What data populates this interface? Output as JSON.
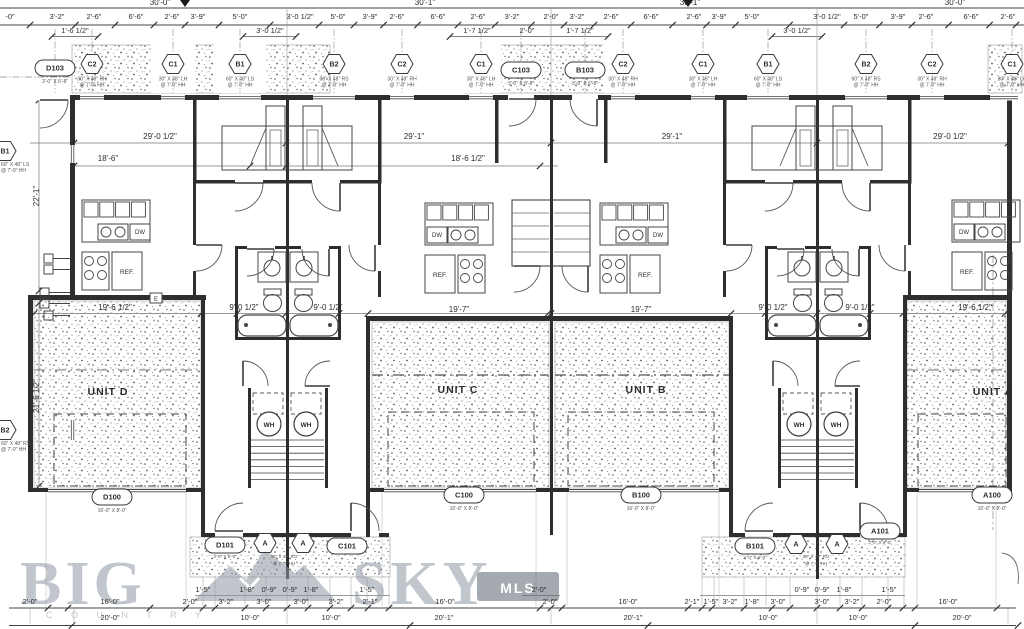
{
  "watermark": {
    "big": "BIG",
    "sky": "SKY",
    "country": "C  O  U  N  T  R  Y",
    "badge": "MLS",
    "color": "#8e98a4",
    "badge_color": "#5a6570"
  },
  "drawing": {
    "unit_labels": [
      {
        "x": 108,
        "y": 395,
        "t": "UNIT D"
      },
      {
        "x": 458,
        "y": 393,
        "t": "UNIT C"
      },
      {
        "x": 646,
        "y": 393,
        "t": "UNIT B"
      },
      {
        "x": 993,
        "y": 395,
        "t": "UNIT A"
      }
    ],
    "top_totals": [
      {
        "x": 160,
        "t": "30'-0\""
      },
      {
        "x": 425,
        "t": "30'-1\""
      },
      {
        "x": 690,
        "t": "30'-1\""
      },
      {
        "x": 955,
        "t": "30'-0\""
      }
    ],
    "top_row1": [
      {
        "x": 10,
        "t": "-0\""
      },
      {
        "x": 57,
        "t": "3'-2\""
      },
      {
        "x": 94,
        "t": "2'-6\""
      },
      {
        "x": 136,
        "t": "6'-6\""
      },
      {
        "x": 172,
        "t": "2'-6\""
      },
      {
        "x": 198,
        "t": "3'-9\""
      },
      {
        "x": 240,
        "t": "5'-0\""
      },
      {
        "x": 300,
        "t": "3'-0 1/2\""
      },
      {
        "x": 338,
        "t": "5'-0\""
      },
      {
        "x": 370,
        "t": "3'-9\""
      },
      {
        "x": 397,
        "t": "2'-6\""
      },
      {
        "x": 438,
        "t": "6'-6\""
      },
      {
        "x": 478,
        "t": "2'-6\""
      },
      {
        "x": 512,
        "t": "3'-2\""
      },
      {
        "x": 551,
        "t": "2'-0\""
      },
      {
        "x": 577,
        "t": "3'-2\""
      },
      {
        "x": 611,
        "t": "2'-6\""
      },
      {
        "x": 651,
        "t": "6'-6\""
      },
      {
        "x": 694,
        "t": "2'-6\""
      },
      {
        "x": 719,
        "t": "3'-9\""
      },
      {
        "x": 752,
        "t": "5'-0\""
      },
      {
        "x": 827,
        "t": "3'-0 1/2\""
      },
      {
        "x": 861,
        "t": "5'-0\""
      },
      {
        "x": 898,
        "t": "3'-9\""
      },
      {
        "x": 926,
        "t": "2'-6\""
      },
      {
        "x": 971,
        "t": "6'-6\""
      },
      {
        "x": 1008,
        "t": "2'-6\""
      }
    ],
    "top_row2": [
      {
        "x": 75,
        "t": "1'-6 1/2\""
      },
      {
        "x": 270,
        "t": "3'-0 1/2\""
      },
      {
        "x": 477,
        "t": "1'-7 1/2\""
      },
      {
        "x": 527,
        "t": "2'-0\""
      },
      {
        "x": 580,
        "t": "1'-7 1/2\""
      },
      {
        "x": 797,
        "t": "3'-0 1/2\""
      }
    ],
    "window_tags": [
      {
        "x": 55,
        "y": 68,
        "label": "D103",
        "shape": "oval",
        "spec": [
          "3'-0\" X 6'-8\""
        ]
      },
      {
        "x": 92,
        "y": 64,
        "label": "C2",
        "shape": "hex",
        "spec": [
          "30\" X 48\" RH",
          "@ 7'-0\" HH"
        ]
      },
      {
        "x": 173,
        "y": 64,
        "label": "C1",
        "shape": "hex",
        "spec": [
          "30\" X 48\" LH",
          "@ 7'-0\" HH"
        ]
      },
      {
        "x": 240,
        "y": 64,
        "label": "B1",
        "shape": "hex",
        "spec": [
          "60\" X 48\" LS",
          "@ 7'-0\" HH"
        ]
      },
      {
        "x": 334,
        "y": 64,
        "label": "B2",
        "shape": "hex",
        "spec": [
          "60\" X 48\" RS",
          "@ 7'-0\" HH"
        ]
      },
      {
        "x": 402,
        "y": 64,
        "label": "C2",
        "shape": "hex",
        "spec": [
          "30\" X 48\" RH",
          "@ 7'-0\" HH"
        ]
      },
      {
        "x": 481,
        "y": 64,
        "label": "C1",
        "shape": "hex",
        "spec": [
          "30\" X 48\" LH",
          "@ 7'-0\" HH"
        ]
      },
      {
        "x": 521,
        "y": 70,
        "label": "C103",
        "shape": "oval",
        "spec": [
          "3'-0\" X 6'-8\""
        ]
      },
      {
        "x": 585,
        "y": 70,
        "label": "B103",
        "shape": "oval",
        "spec": [
          "3'-0\" X 6'-8\""
        ]
      },
      {
        "x": 623,
        "y": 64,
        "label": "C2",
        "shape": "hex",
        "spec": [
          "30\" X 48\" RH",
          "@ 7'-0\" HH"
        ]
      },
      {
        "x": 703,
        "y": 64,
        "label": "C1",
        "shape": "hex",
        "spec": [
          "30\" X 48\" LH",
          "@ 7'-0\" HH"
        ]
      },
      {
        "x": 768,
        "y": 64,
        "label": "B1",
        "shape": "hex",
        "spec": [
          "60\" X 48\" LS",
          "@ 7'-0\" HH"
        ]
      },
      {
        "x": 866,
        "y": 64,
        "label": "B2",
        "shape": "hex",
        "spec": [
          "60\" X 48\" RS",
          "@ 7'-0\" HH"
        ]
      },
      {
        "x": 932,
        "y": 64,
        "label": "C2",
        "shape": "hex",
        "spec": [
          "30\" X 48\" RH",
          "@ 7'-0\" HH"
        ]
      },
      {
        "x": 1012,
        "y": 64,
        "label": "C1",
        "shape": "hex",
        "spec": [
          "30\" X 48\" LH",
          "@ 7'-0\" HH"
        ]
      }
    ],
    "left_tags": [
      {
        "y": 151,
        "label": "B1",
        "spec": [
          "60\" X 48\" LS",
          "@ 7'-0\" HH"
        ]
      },
      {
        "y": 430,
        "label": "B2",
        "spec": [
          "60\" X 48\" RS",
          "@ 7'-0\" HH"
        ]
      }
    ],
    "interior_dims": [
      {
        "x": 160,
        "y": 139,
        "t": "29'-0 1/2\""
      },
      {
        "x": 414,
        "y": 139,
        "t": "29'-1\""
      },
      {
        "x": 672,
        "y": 139,
        "t": "29'-1\""
      },
      {
        "x": 950,
        "y": 139,
        "t": "29'-0 1/2\""
      },
      {
        "x": 108,
        "y": 161,
        "t": "18'-6\""
      },
      {
        "x": 468,
        "y": 161,
        "t": "18'-6 1/2\""
      },
      {
        "x": 115,
        "y": 310,
        "t": "19'-6 1/2\""
      },
      {
        "x": 244,
        "y": 310,
        "t": "9'-0 1/2\""
      },
      {
        "x": 328,
        "y": 310,
        "t": "9'-0 1/2\""
      },
      {
        "x": 459,
        "y": 312,
        "t": "19'-7\""
      },
      {
        "x": 641,
        "y": 312,
        "t": "19'-7\""
      },
      {
        "x": 773,
        "y": 310,
        "t": "9'-0 1/2\""
      },
      {
        "x": 860,
        "y": 310,
        "t": "9'-0 1/2\""
      },
      {
        "x": 975,
        "y": 310,
        "t": "19'-6 1/2\""
      }
    ],
    "vertical_dims": [
      {
        "x": 39,
        "y": 196,
        "t": "22'-1\""
      },
      {
        "x": 39,
        "y": 396,
        "t": "21'-6 1/2\""
      }
    ],
    "garage_tags": [
      {
        "x": 112,
        "y": 497,
        "t": "D100",
        "sub": "16'-0\" X 8'-0\""
      },
      {
        "x": 464,
        "y": 495,
        "t": "C100",
        "sub": "16'-0\" X 8'-0\""
      },
      {
        "x": 641,
        "y": 495,
        "t": "B100",
        "sub": "16'-0\" X 8'-0\""
      },
      {
        "x": 992,
        "y": 495,
        "t": "A100",
        "sub": "16'-0\" X 8'-0\""
      }
    ],
    "entry_oval_tags": [
      {
        "x": 225,
        "y": 545,
        "t": "D101",
        "sub": "3'-0\" X 8'-0\""
      },
      {
        "x": 347,
        "y": 546,
        "t": "C101",
        "sub": ""
      },
      {
        "x": 755,
        "y": 546,
        "t": "B101",
        "sub": "3'-0\" X 8'-0\""
      },
      {
        "x": 880,
        "y": 531,
        "t": "A101",
        "sub": "3'-0\" X 8'-0\""
      }
    ],
    "entry_hex_tags": [
      {
        "x": 265,
        "y": 543,
        "t": "A"
      },
      {
        "x": 303,
        "y": 543,
        "t": "A"
      },
      {
        "x": 796,
        "y": 544,
        "t": "A"
      },
      {
        "x": 837,
        "y": 544,
        "t": "A"
      }
    ],
    "entry_hex_specs": [
      {
        "x": 284,
        "y": 558,
        "t": "36\" X 42\" RO"
      },
      {
        "x": 284,
        "y": 565,
        "t": "@ 7'-0\" HH"
      },
      {
        "x": 816,
        "y": 558,
        "t": "36\" X 42\" RO"
      },
      {
        "x": 816,
        "y": 565,
        "t": "@ 7'-0\" HH"
      }
    ],
    "bottom_rowA": [
      {
        "x": 203,
        "t": "1'-5\""
      },
      {
        "x": 247,
        "t": "1'-8\""
      },
      {
        "x": 269,
        "t": "0'-9\""
      },
      {
        "x": 290,
        "t": "0'-9\""
      },
      {
        "x": 311,
        "t": "1'-8\""
      },
      {
        "x": 367,
        "t": "1'-5\""
      },
      {
        "x": 539,
        "t": "2'-0\""
      },
      {
        "x": 802,
        "t": "0'-9\""
      },
      {
        "x": 822,
        "t": "0'-9\""
      },
      {
        "x": 844,
        "t": "1'-8\""
      },
      {
        "x": 889,
        "t": "1'-5\""
      }
    ],
    "bottom_rowB": [
      {
        "x": 30,
        "t": "2'-0\""
      },
      {
        "x": 110,
        "t": "16'-0\""
      },
      {
        "x": 190,
        "t": "2'-0\""
      },
      {
        "x": 226,
        "t": "3'-2\""
      },
      {
        "x": 264,
        "t": "3'-0\""
      },
      {
        "x": 301,
        "t": "3'-0\""
      },
      {
        "x": 336,
        "t": "3'-2\""
      },
      {
        "x": 370,
        "t": "2'-1\""
      },
      {
        "x": 445,
        "t": "16'-0\""
      },
      {
        "x": 550,
        "t": "2'-0\""
      },
      {
        "x": 628,
        "t": "16'-0\""
      },
      {
        "x": 692,
        "t": "2'-1\""
      },
      {
        "x": 711,
        "t": "1'-5\""
      },
      {
        "x": 730,
        "t": "3'-2\""
      },
      {
        "x": 752,
        "t": "1'-8\""
      },
      {
        "x": 778,
        "t": "3'-0\""
      },
      {
        "x": 822,
        "t": "3'-0\""
      },
      {
        "x": 852,
        "t": "3'-2\""
      },
      {
        "x": 884,
        "t": "2'-0\""
      },
      {
        "x": 948,
        "t": "16'-0\""
      }
    ],
    "bottom_rowC": [
      {
        "x": 110,
        "t": "20'-0\""
      },
      {
        "x": 250,
        "t": "10'-0\""
      },
      {
        "x": 331,
        "t": "10'-0\""
      },
      {
        "x": 444,
        "t": "20'-1\""
      },
      {
        "x": 633,
        "t": "20'-1\""
      },
      {
        "x": 768,
        "t": "10'-0\""
      },
      {
        "x": 858,
        "t": "10'-0\""
      },
      {
        "x": 962,
        "t": "20'-0\""
      }
    ],
    "fixtures": {
      "ref": "REF.",
      "dw": "DW",
      "wh": "WH",
      "e": "E"
    }
  }
}
